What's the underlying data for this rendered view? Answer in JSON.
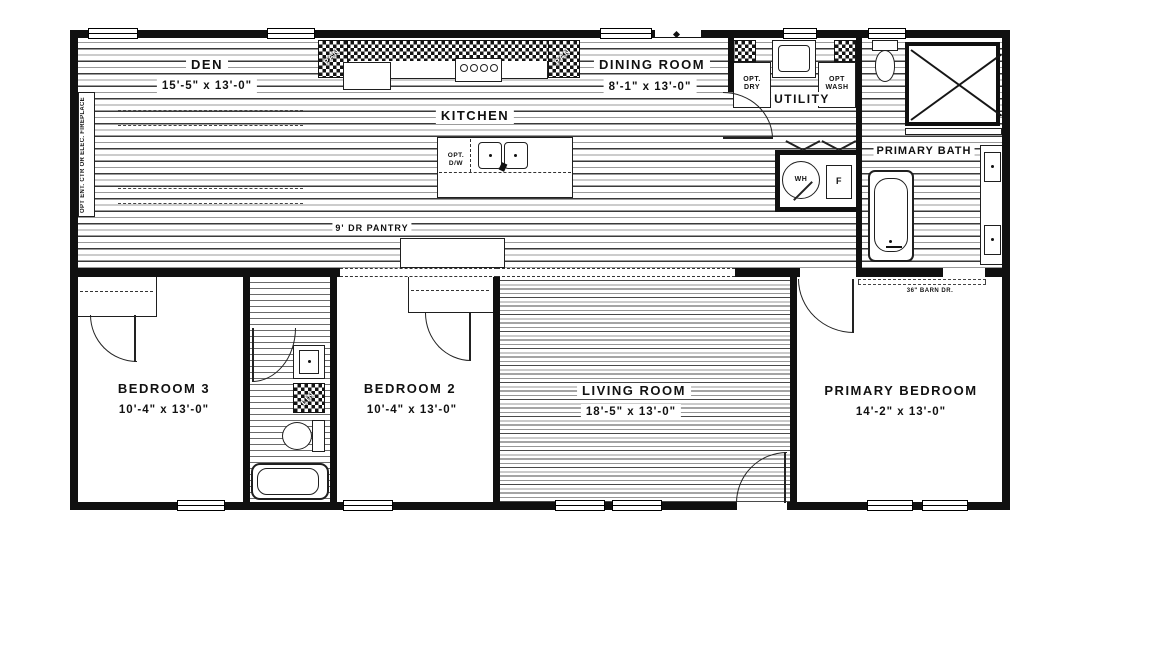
{
  "rooms": {
    "den": {
      "name": "DEN",
      "dims": "15'-5\" x 13'-0\""
    },
    "kitchen": {
      "name": "KITCHEN"
    },
    "dining": {
      "name": "DINING ROOM",
      "dims": "8'-1\" x 13'-0\""
    },
    "utility": {
      "name": "UTILITY"
    },
    "primary_bath": {
      "name": "PRIMARY BATH"
    },
    "bedroom3": {
      "name": "BEDROOM 3",
      "dims": "10'-4\" x 13'-0\""
    },
    "bedroom2": {
      "name": "BEDROOM 2",
      "dims": "10'-4\" x 13'-0\""
    },
    "living": {
      "name": "LIVING ROOM",
      "dims": "18'-5\" x 13'-0\""
    },
    "primary_bedroom": {
      "name": "PRIMARY BEDROOM",
      "dims": "14'-2\" x 13'-0\""
    }
  },
  "labels": {
    "pantry": "9' DR PANTRY",
    "opt_dw": "OPT. D/W",
    "opt_dry": "OPT. DRY",
    "opt_wash": "OPT WASH",
    "wh": "WH",
    "f": "F",
    "barn_door": "36\" BARN DR.",
    "opt_ent": "OPT ENT. CTR OR ELEC. FIREPLACE",
    "pan": "PAN",
    "lin": "LIN"
  },
  "colors": {
    "wall": "#101010",
    "line": "#1f1f1f",
    "floor_line": "#6a6a6a"
  }
}
